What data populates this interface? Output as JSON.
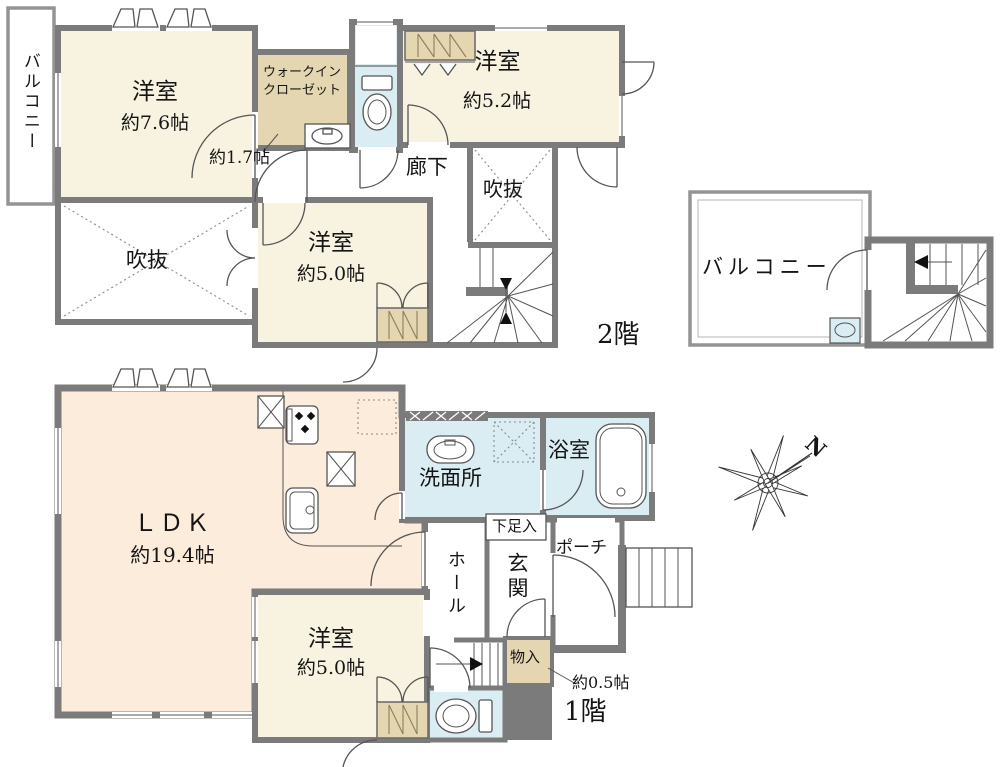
{
  "colors": {
    "wall": "#7b7b7b",
    "cream": "#f7f3e0",
    "peach": "#fcecdc",
    "tan": "#e4d6b0",
    "water": "#d9edf2"
  },
  "floors": {
    "f2": {
      "floor_label": "2階",
      "balcony": "バルコニー",
      "room76": {
        "name": "洋室",
        "size": "約7.6帖"
      },
      "wic": {
        "line1": "ウォークイン",
        "line2": "クローゼット",
        "size": "約1.7帖"
      },
      "room52": {
        "name": "洋室",
        "size": "約5.2帖"
      },
      "corridor": "廊下",
      "void_small": "吹抜",
      "void_large": "吹抜",
      "room50": {
        "name": "洋室",
        "size": "約5.0帖"
      }
    },
    "roof": {
      "balcony": "バルコニー"
    },
    "f1": {
      "floor_label": "1階",
      "ldk": {
        "name": "ＬＤＫ",
        "size": "約19.4帖"
      },
      "washroom": "洗面所",
      "bathroom": "浴室",
      "shoebox": "下足入",
      "hall": "ホール",
      "entrance": "玄関",
      "porch": "ポーチ",
      "storage": {
        "name": "物入",
        "size": "約0.5帖"
      },
      "room50": {
        "name": "洋室",
        "size": "約5.0帖"
      }
    }
  },
  "compass": {
    "north": "N"
  }
}
